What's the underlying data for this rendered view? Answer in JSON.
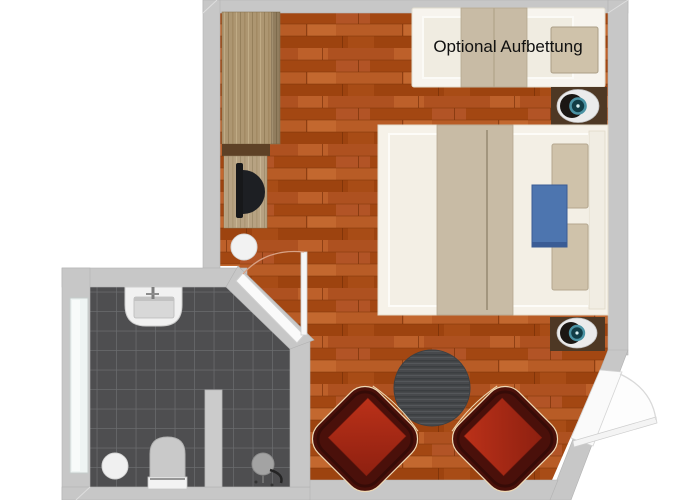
{
  "page": {
    "type": "floor-plan",
    "background": "#ffffff"
  },
  "labels": {
    "optional_bed": "Optional Aufbettung"
  },
  "colors": {
    "wall": "#c7c7c7",
    "wall_edge": "#b2b2b2",
    "floor_wood": "#a84e1c",
    "bathroom_tile": "#4e4e50",
    "tile_grout": "#696b6d",
    "furniture_wood": "#ad9671",
    "desk_wood": "#b7a17e",
    "shelf_dark": "#5e4126",
    "nightstand": "#4e3824",
    "bed_frame": "#f6f2e9",
    "mattress": "#f3efe5",
    "blanket": "#c8bba5",
    "pillow": "#cfc2aa",
    "accent_blue": "#4d75af",
    "armchair_shell": "#4a100a",
    "armchair_seat": "#b02c1a",
    "piping": "#eed9b5",
    "rug": "#47494c",
    "lamp_teal": "#4b93a4",
    "door_arc": "#d8a184",
    "fixture_gray": "#c9c9c9",
    "window_glass": "#eef4f3"
  },
  "rooms": [
    {
      "name": "bedroom",
      "floor": "wood-parquet"
    },
    {
      "name": "bathroom",
      "floor": "dark-tile"
    }
  ],
  "furniture": [
    "wardrobe",
    "desk",
    "desk-chair",
    "waste-bin",
    "sofa-bed-optional",
    "nightstand-top",
    "nightstand-bottom",
    "table-lamp-top",
    "table-lamp-bottom",
    "double-bed",
    "bed-pillows",
    "bed-runner-blue",
    "round-rug-table",
    "armchair-left",
    "armchair-right",
    "sink",
    "toilet",
    "shower",
    "bath-stool",
    "partition-wall",
    "bathroom-window",
    "bathroom-door",
    "entrance-door"
  ]
}
